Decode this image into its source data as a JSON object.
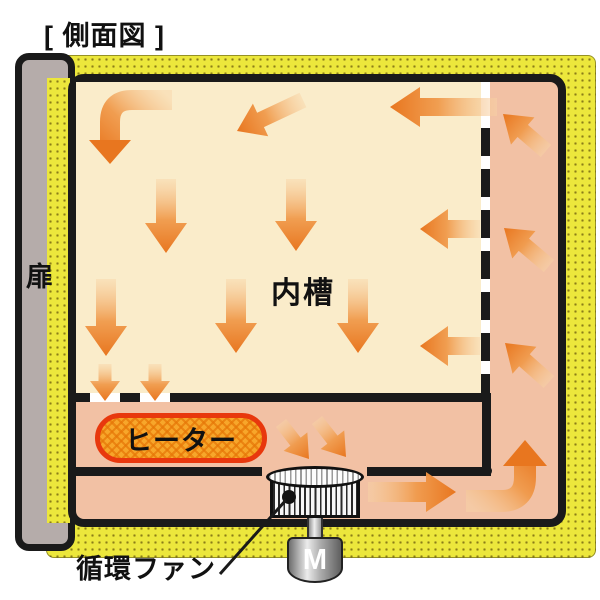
{
  "diagram": {
    "title": "[ 側面図 ]",
    "door_label": "扉",
    "chamber_label": "内槽",
    "heater_label": "ヒーター",
    "fan_label": "循環ファン",
    "motor_label": "M"
  },
  "colors": {
    "insulation_yellow": "#ece73c",
    "insulation_dot": "#8a7d18",
    "duct_salmon": "#f2c1a4",
    "chamber_cream": "#faecca",
    "door_gray": "#b5acaa",
    "wall_black": "#1a1a1a",
    "heater_fill": "#f7a62a",
    "heater_border": "#e8380d",
    "arrow_tail": "#f8d4a6",
    "arrow_mid": "#f09a4b",
    "arrow_head": "#e8761f"
  },
  "flow_arrows": {
    "straight": [
      {
        "dir": "down-left",
        "x1": 303,
        "y1": 100,
        "x2": 237,
        "y2": 131,
        "w": 16,
        "hw": 36,
        "hl": 26
      },
      {
        "dir": "left",
        "x1": 497,
        "y1": 107,
        "x2": 390,
        "y2": 107,
        "w": 18,
        "hw": 40,
        "hl": 30
      },
      {
        "dir": "down",
        "x1": 166,
        "y1": 179,
        "x2": 166,
        "y2": 253,
        "w": 20,
        "hw": 42,
        "hl": 30
      },
      {
        "dir": "down",
        "x1": 296,
        "y1": 179,
        "x2": 296,
        "y2": 251,
        "w": 20,
        "hw": 42,
        "hl": 30
      },
      {
        "dir": "left",
        "x1": 480,
        "y1": 229,
        "x2": 420,
        "y2": 229,
        "w": 18,
        "hw": 40,
        "hl": 28
      },
      {
        "dir": "down",
        "x1": 106,
        "y1": 279,
        "x2": 106,
        "y2": 356,
        "w": 20,
        "hw": 42,
        "hl": 30
      },
      {
        "dir": "down",
        "x1": 236,
        "y1": 279,
        "x2": 236,
        "y2": 353,
        "w": 20,
        "hw": 42,
        "hl": 30
      },
      {
        "dir": "down",
        "x1": 358,
        "y1": 279,
        "x2": 358,
        "y2": 353,
        "w": 20,
        "hw": 42,
        "hl": 30
      },
      {
        "dir": "left",
        "x1": 480,
        "y1": 346,
        "x2": 420,
        "y2": 346,
        "w": 18,
        "hw": 40,
        "hl": 28
      },
      {
        "dir": "down",
        "x1": 105,
        "y1": 364,
        "x2": 105,
        "y2": 401,
        "w": 13,
        "hw": 30,
        "hl": 20
      },
      {
        "dir": "down",
        "x1": 155,
        "y1": 364,
        "x2": 155,
        "y2": 401,
        "w": 13,
        "hw": 30,
        "hl": 20
      },
      {
        "dir": "down-right",
        "x1": 281,
        "y1": 423,
        "x2": 309,
        "y2": 459,
        "w": 13,
        "hw": 30,
        "hl": 22
      },
      {
        "dir": "down-right",
        "x1": 317,
        "y1": 420,
        "x2": 346,
        "y2": 457,
        "w": 13,
        "hw": 30,
        "hl": 22
      },
      {
        "dir": "right",
        "x1": 368,
        "y1": 492,
        "x2": 456,
        "y2": 492,
        "w": 20,
        "hw": 40,
        "hl": 30
      },
      {
        "dir": "up-left",
        "x1": 546,
        "y1": 151,
        "x2": 503,
        "y2": 114,
        "w": 16,
        "hw": 36,
        "hl": 26
      },
      {
        "dir": "up-left",
        "x1": 549,
        "y1": 266,
        "x2": 504,
        "y2": 228,
        "w": 16,
        "hw": 36,
        "hl": 26
      },
      {
        "dir": "up-left",
        "x1": 549,
        "y1": 382,
        "x2": 505,
        "y2": 343,
        "w": 16,
        "hw": 36,
        "hl": 26
      }
    ],
    "elbows": [
      {
        "dir": "east-to-south",
        "x1": 172,
        "y1": 100,
        "cx": 110,
        "cy": 100,
        "x2": 110,
        "y2": 164,
        "w": 20,
        "hw": 42,
        "hl": 24,
        "r": 22
      },
      {
        "dir": "west-to-north",
        "x1": 466,
        "y1": 501,
        "cx": 525,
        "cy": 501,
        "x2": 525,
        "y2": 440,
        "w": 22,
        "hw": 44,
        "hl": 26,
        "r": 24
      }
    ]
  }
}
